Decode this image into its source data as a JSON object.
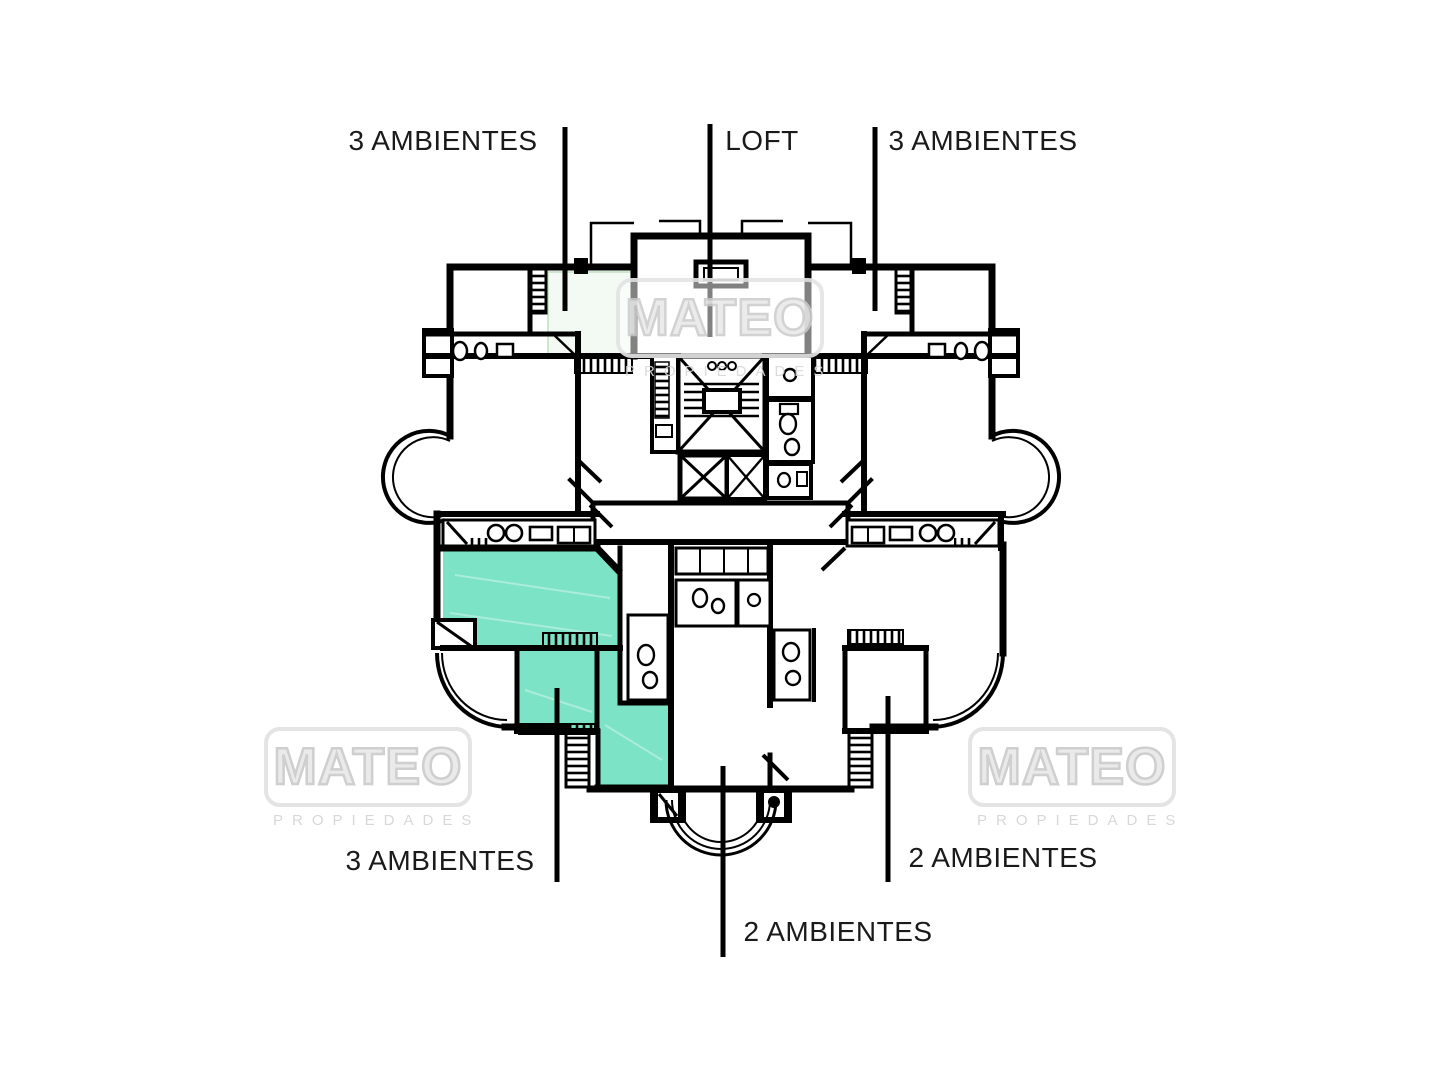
{
  "units": {
    "top_left": "3 AMBIENTES",
    "top_center": "LOFT",
    "top_right": "3 AMBIENTES",
    "bottom_left": "3 AMBIENTES",
    "bottom_center": "2 AMBIENTES",
    "bottom_right": "2 AMBIENTES"
  },
  "watermark": {
    "brand": "MATEO",
    "subtitle": "PROPIEDADES"
  },
  "colors": {
    "highlight": "#7de3c6",
    "line": "#000000",
    "watermark_gray": "#d9d9d9",
    "label_text": "#1a1a1a"
  }
}
